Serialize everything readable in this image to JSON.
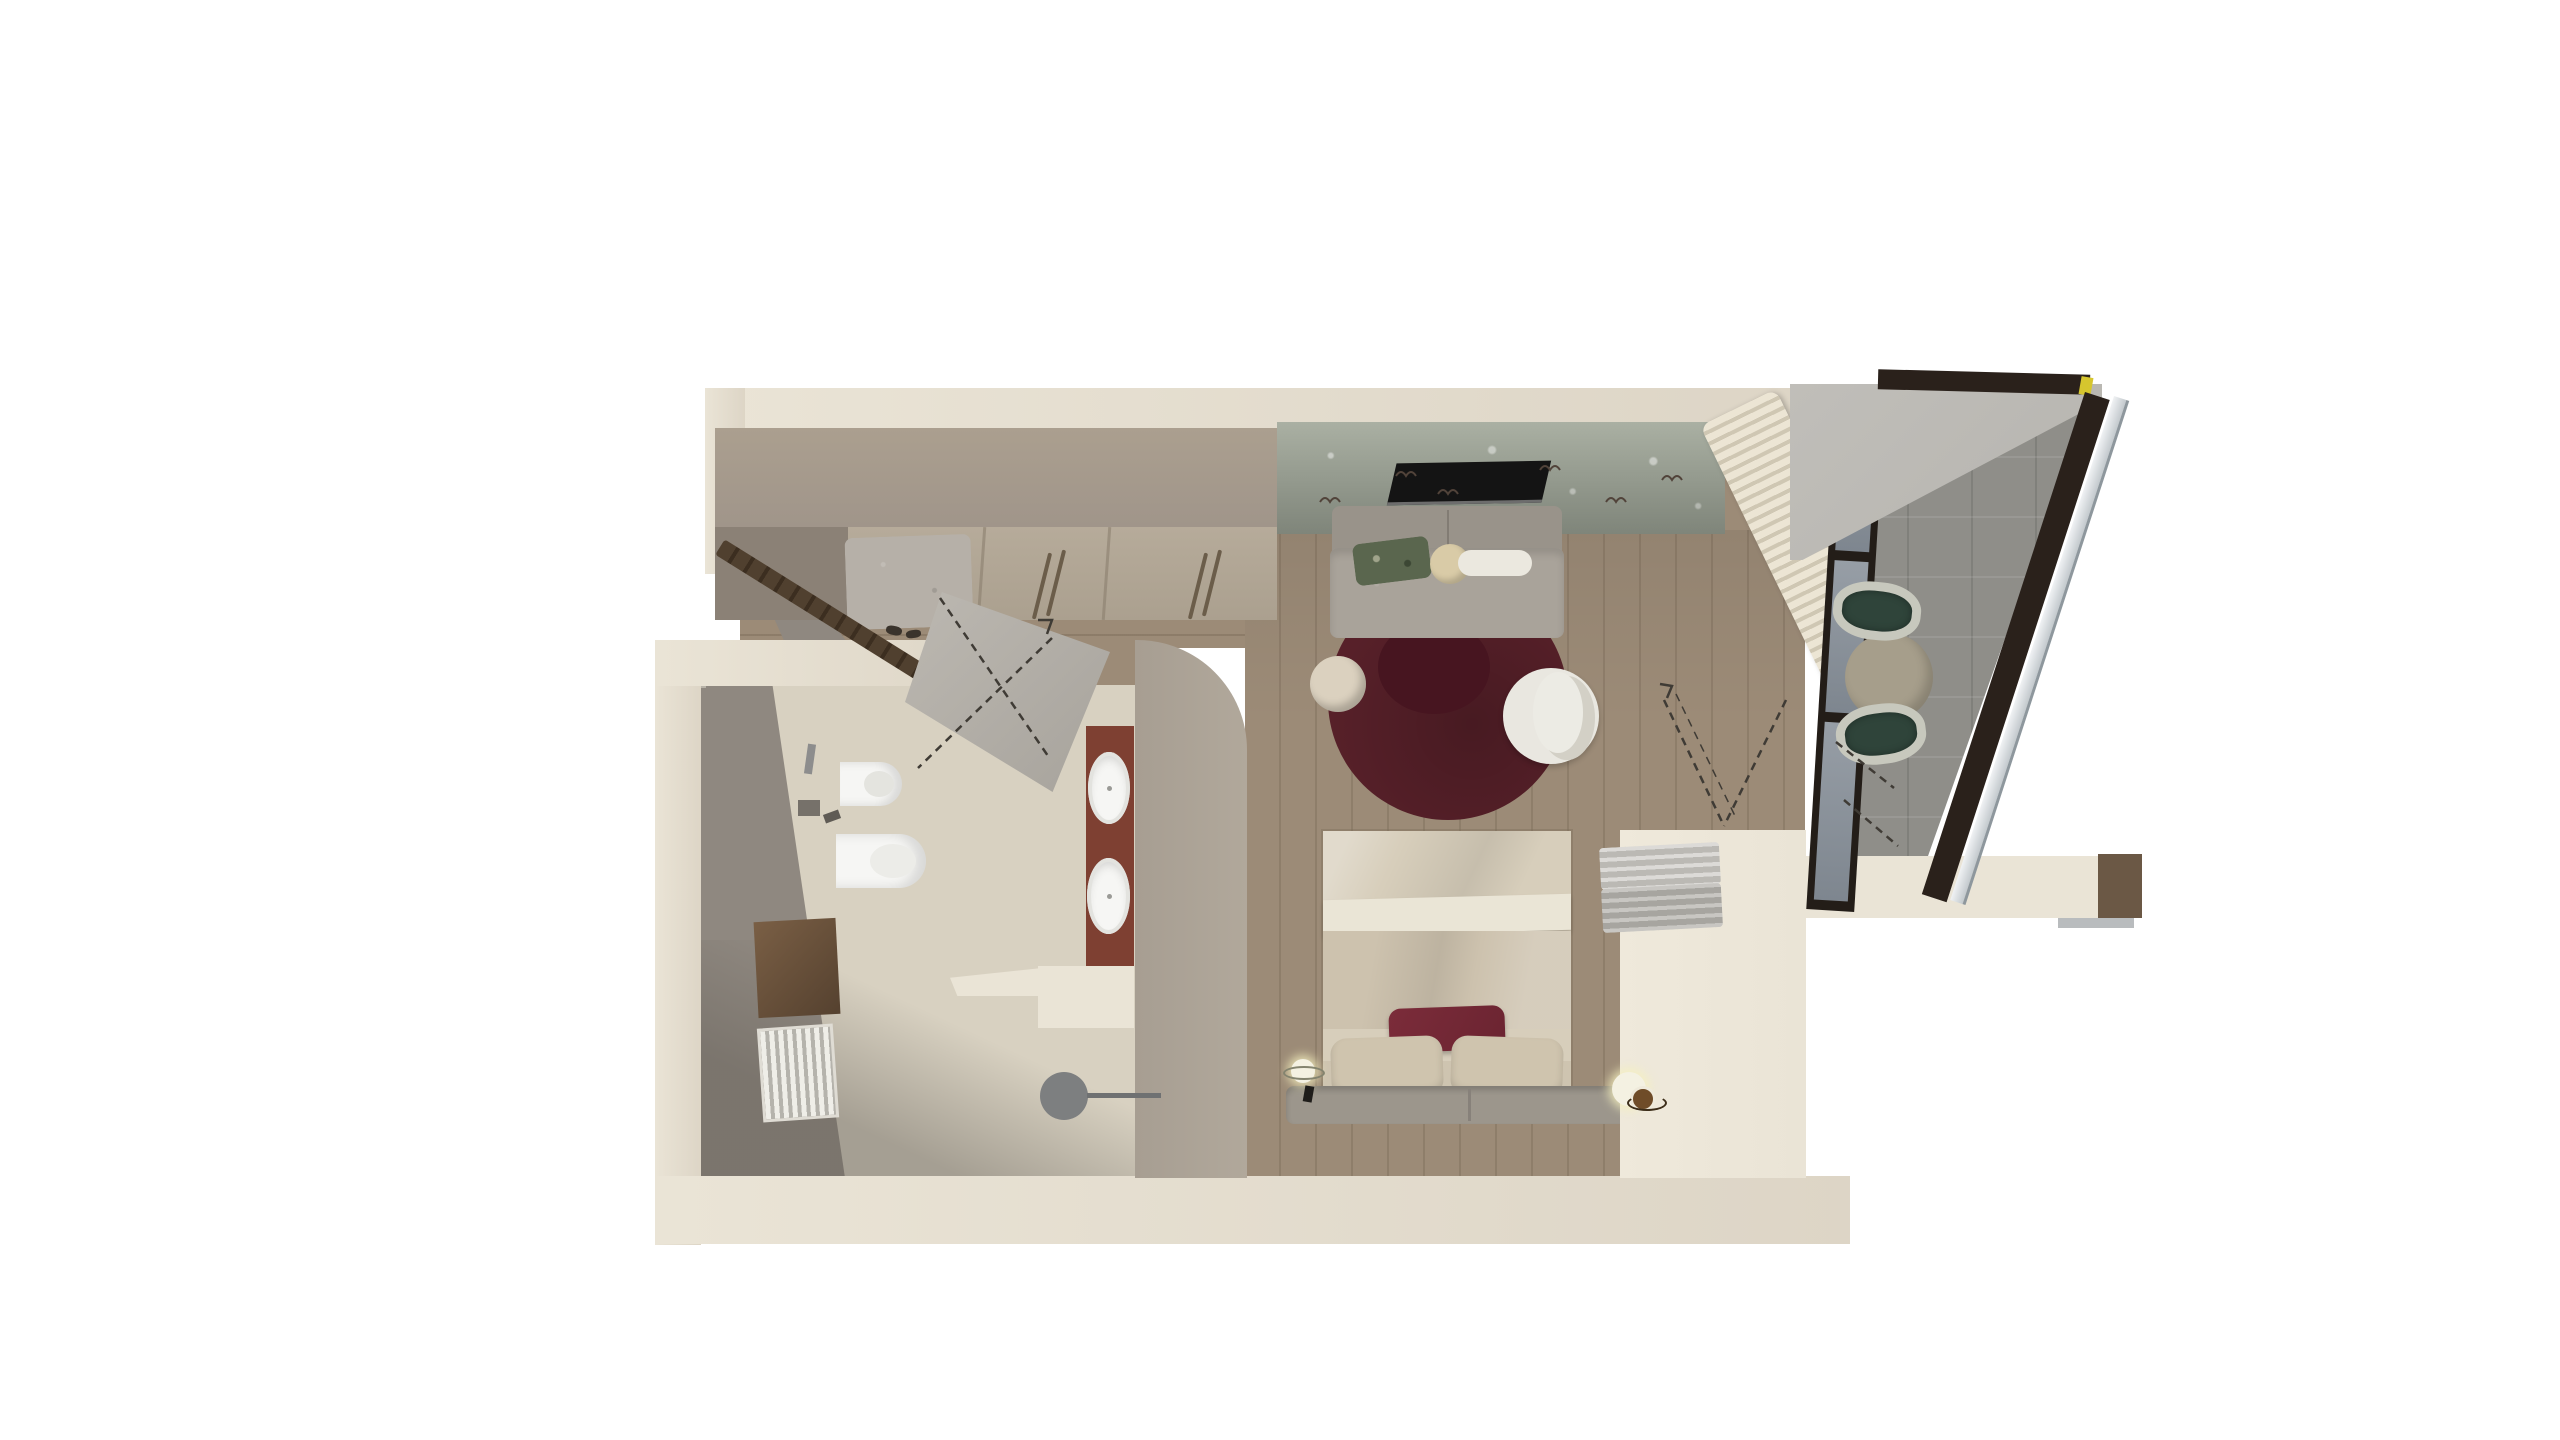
{
  "scene": {
    "type": "3d-floor-plan-top-view",
    "description": "Top-down 3D rendering of a studio suite floor plan on a white background: entry hall with wardrobe, bathroom, combined bedroom/living room, and a glazed balcony loggia with outdoor table and chairs",
    "background": "#ffffff",
    "visible_text": ""
  },
  "palette": {
    "wall_cream": "#ddd5c6",
    "wall_cream_light": "#eae4d6",
    "wall_taupe": "#b1a89b",
    "wall_gray_face": "#8f8880",
    "wood_floor": "#9c8b77",
    "bath_floor": "#d8d1c1",
    "rug": "#572029",
    "rug_inner": "#471520",
    "bed_linen": "#cec4b0",
    "sheet_white": "#eae5d6",
    "pillow_beige": "#cfc4ae",
    "accent_burgundy": "#6b2431",
    "headboard_gray": "#9c968c",
    "towel_gray": "#b5b3ae",
    "towel_light": "#c9c7c2",
    "bench_gray": "#b6b0a8",
    "sofa_gray": "#a8a299",
    "pouf_cream": "#dbd1bf",
    "chair_white": "#e9e7e0",
    "wallpaper_sage": "#99a192",
    "tv_black": "#141414",
    "glass": "#8c939c",
    "frame_dark": "#231d18",
    "frame_dark2": "#2a211b",
    "balcony_floor": "#8f8e89",
    "slab_gray": "#b6b4af",
    "table_beige": "#a69e8b",
    "chair_green": "#2f443a",
    "wicker": "#c7c8bd",
    "terracotta": "#7e4032",
    "cabinet_wood": "#6e5540",
    "door_wood": "#4b392b",
    "fixture_white": "#f6f6f4",
    "stool_gray": "#7d7f80",
    "lamp_white": "#f4f1e2",
    "tray_brown": "#6f4c28",
    "railing_light": "#eef0f2",
    "cap_brown": "#6b5845",
    "accent_yellow": "#d6c62e",
    "shoe_dark": "#3a332c"
  },
  "rooms": [
    {
      "id": "entry",
      "name": "Entry hall",
      "items": [
        "open front door (dark wood)",
        "built-in wardrobe with handle pairs",
        "open niche with bench cushion",
        "pair of shoes",
        "wood plank floor"
      ]
    },
    {
      "id": "bathroom",
      "name": "Bathroom",
      "items": [
        "open bathroom door with swing lines",
        "wall-hung bidet",
        "wall-hung toilet",
        "wall accessories",
        "wooden wall cabinet",
        "towel radiator",
        "terracotta vanity ledge",
        "two oval countertop sinks",
        "stone ledge",
        "round gray stool",
        "window notch"
      ]
    },
    {
      "id": "bedroom_living",
      "name": "Bedroom / living room",
      "items": [
        "sage floral wallpaper wall",
        "wall-mounted TV",
        "gray sofa",
        "green patterned pillow",
        "round cream cushion",
        "white bolster",
        "burgundy round rug with inner circle",
        "cream pouf",
        "white swivel armchair",
        "double bed with beige duvet and white sheet band",
        "burgundy accent pillow",
        "two beige pillows",
        "gray upholstered headboard bench",
        "left bedside lamp with ring",
        "right bedside lamp with brown tray",
        "linen half wall with stacked gray towels",
        "folded cream curtain stack"
      ]
    },
    {
      "id": "balcony",
      "name": "Glazed balcony loggia",
      "items": [
        "black-framed glass partition with door swing lines",
        "stone tile floor",
        "round beige table",
        "two green wicker chairs",
        "concrete roof slab",
        "dark perimeter band with yellow corner sliver",
        "light glass railing strip",
        "exterior wall stub with brown cap"
      ]
    }
  ]
}
